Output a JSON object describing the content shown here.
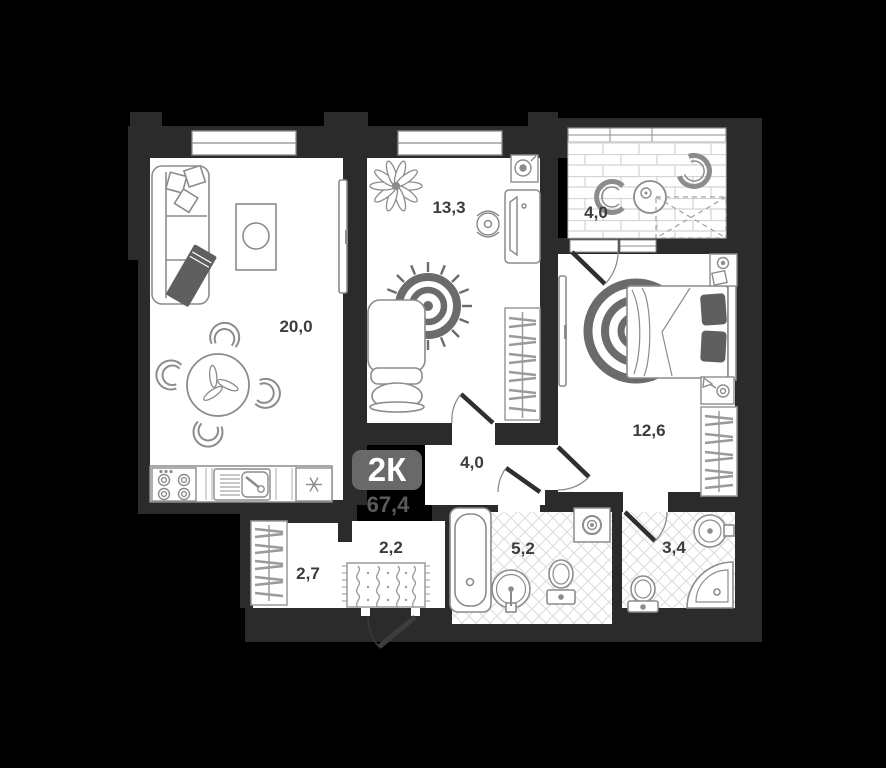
{
  "plan": {
    "badge": "2К",
    "total_area": "67,4",
    "rooms": [
      {
        "name": "living-kitchen",
        "area": "20,0"
      },
      {
        "name": "bedroom-2",
        "area": "13,3"
      },
      {
        "name": "balcony",
        "area": "4,0"
      },
      {
        "name": "bedroom-1",
        "area": "12,6"
      },
      {
        "name": "hallway",
        "area": "4,0"
      },
      {
        "name": "entry-hall",
        "area": "2,2"
      },
      {
        "name": "wardrobe-room",
        "area": "2,7"
      },
      {
        "name": "bathroom",
        "area": "5,2"
      },
      {
        "name": "wc",
        "area": "3,4"
      }
    ],
    "colors": {
      "background": "#000000",
      "wall": "#2b2b2b",
      "floor": "#ffffff",
      "furniture_line": "#8c8c8c",
      "furniture_dark": "#5f5f5f",
      "label_text": "#3c3c3c",
      "badge_bg": "#696969",
      "badge_text": "#ffffff",
      "total_text": "#5a5a5a"
    }
  }
}
